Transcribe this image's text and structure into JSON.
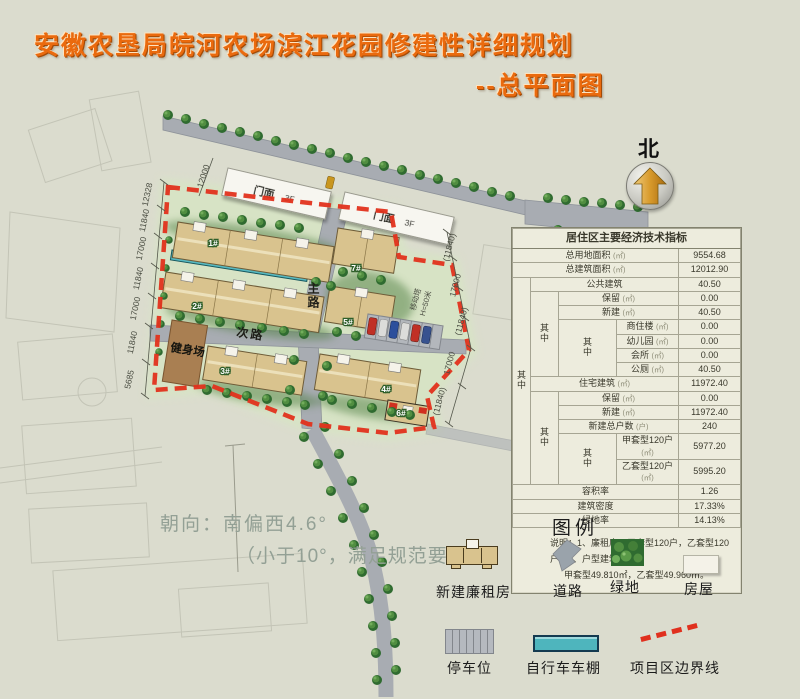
{
  "page": {
    "title": "安徽农垦局皖河农场滨江花园修建性详细规划",
    "subtitle": "--总平面图"
  },
  "colors": {
    "accent_orange": "#ea6a0e",
    "boundary_red": "#e0301e",
    "shed_teal": "#4eb5bd",
    "building_tan": "#d9c38e",
    "road_gray": "#a8acb2",
    "tree_green": "#2f6b30"
  },
  "north": {
    "label": "北"
  },
  "plan": {
    "storefront_label": "门面",
    "storefront_floors": "3F",
    "main_road": "主路",
    "secondary_road": "次路",
    "fitness": "健身场",
    "buildings": [
      "1#",
      "2#",
      "3#",
      "4#",
      "5#",
      "6#",
      "7#"
    ],
    "tower_line1": "移动塔",
    "tower_line2": "H=50米",
    "orientation_line1": "朝向：南偏西4.6°",
    "orientation_line2": "（小于10°，满足规范要求）",
    "dim_top": "12000",
    "dims_left": [
      "12328",
      "11840",
      "17000",
      "11840",
      "17000",
      "11840",
      "5685"
    ],
    "dims_right": [
      "(11840)",
      "17000",
      "(11840)",
      "17000",
      "(11840)"
    ]
  },
  "table": {
    "title": "居住区主要经济技术指标",
    "sub_label": "其中",
    "rows": [
      {
        "label": "总用地面积",
        "unit": "(㎡)",
        "value": "9554.68"
      },
      {
        "label": "总建筑面积",
        "unit": "(㎡)",
        "value": "12012.90"
      },
      {
        "label": "公共建筑",
        "unit": "",
        "value": "40.50"
      },
      {
        "label": "保留",
        "unit": "(㎡)",
        "value": "0.00"
      },
      {
        "label": "新建",
        "unit": "(㎡)",
        "value": "40.50"
      },
      {
        "label": "商住楼",
        "unit": "(㎡)",
        "value": "0.00"
      },
      {
        "label": "幼儿园",
        "unit": "(㎡)",
        "value": "0.00"
      },
      {
        "label": "会所",
        "unit": "(㎡)",
        "value": "0.00"
      },
      {
        "label": "公厕",
        "unit": "(㎡)",
        "value": "40.50"
      },
      {
        "label": "住宅建筑",
        "unit": "(㎡)",
        "value": "11972.40"
      },
      {
        "label": "保留",
        "unit": "(㎡)",
        "value": "0.00"
      },
      {
        "label": "新建",
        "unit": "(㎡)",
        "value": "11972.40"
      },
      {
        "label": "新建总户数",
        "unit": "(户)",
        "value": "240"
      },
      {
        "label": "甲套型120户",
        "unit": "(㎡)",
        "value": "5977.20"
      },
      {
        "label": "乙套型120户",
        "unit": "(㎡)",
        "value": "5995.20"
      },
      {
        "label": "容积率",
        "unit": "",
        "value": "1.26"
      },
      {
        "label": "建筑密度",
        "unit": "",
        "value": "17.33%"
      },
      {
        "label": "绿地率",
        "unit": "",
        "value": "14.13%"
      }
    ],
    "note_line1": "说明：1、廉租房：甲套型120户，乙套型120户；2、户型建筑面积：",
    "note_line2": "甲套型49.810㎡，乙套型49.960㎡。"
  },
  "legend": {
    "title": "图例",
    "items": [
      {
        "label": "新建廉租房"
      },
      {
        "label": "道路"
      },
      {
        "label": "绿地"
      },
      {
        "label": "房屋"
      },
      {
        "label": "停车位"
      },
      {
        "label": "自行车车棚"
      },
      {
        "label": "项目区边界线"
      }
    ]
  }
}
